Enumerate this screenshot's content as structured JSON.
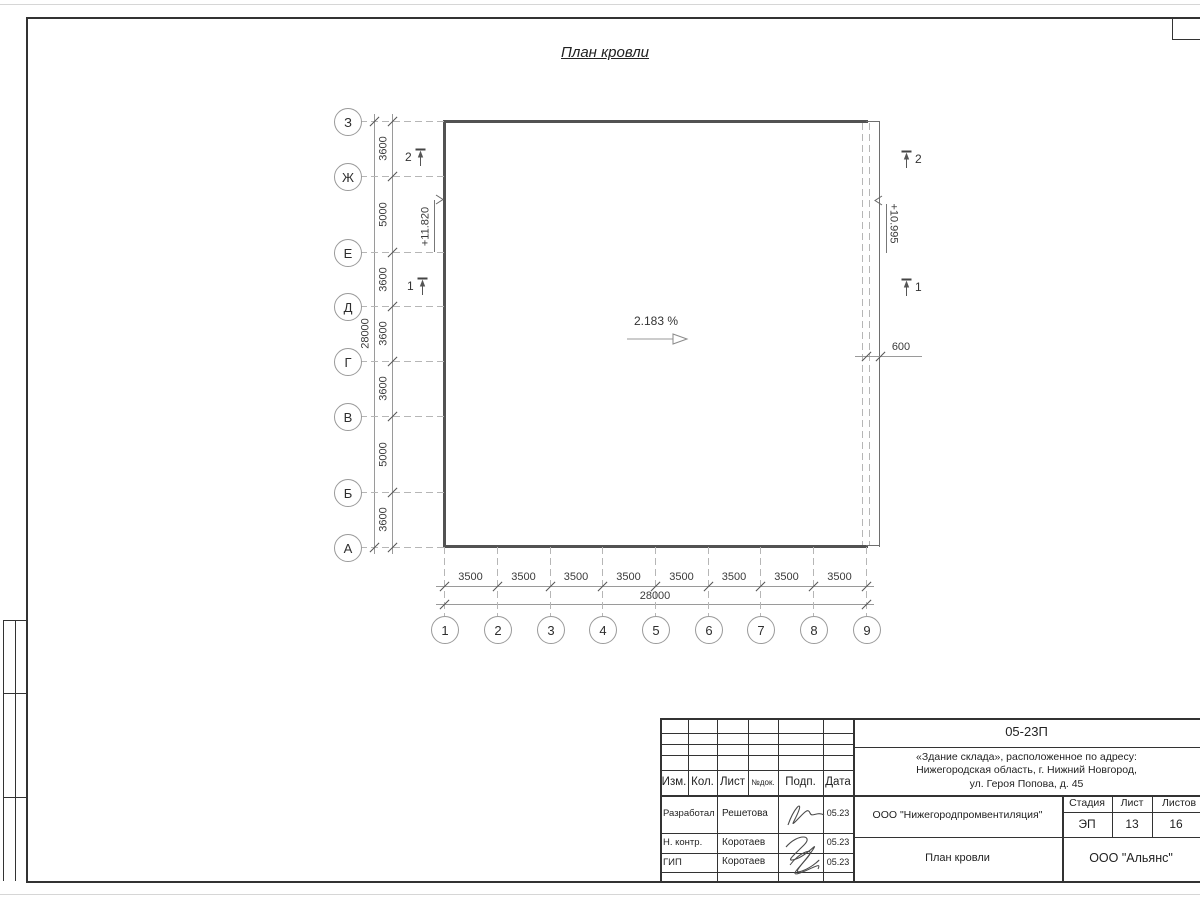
{
  "title": "План кровли",
  "plan": {
    "slope_label": "2.183 %",
    "elevation_left": "+11.820",
    "elevation_right": "+10.995",
    "overhang_dim": "600",
    "axes_left": [
      "З",
      "Ж",
      "Е",
      "Д",
      "Г",
      "В",
      "Б",
      "А"
    ],
    "axes_bottom": [
      "1",
      "2",
      "3",
      "4",
      "5",
      "6",
      "7",
      "8",
      "9"
    ],
    "dims_left": [
      "3600",
      "5000",
      "3600",
      "3600",
      "3600",
      "5000",
      "3600"
    ],
    "dims_left_total": "28000",
    "dims_bottom": [
      "3500",
      "3500",
      "3500",
      "3500",
      "3500",
      "3500",
      "3500",
      "3500"
    ],
    "dims_bottom_total": "28000",
    "section_marks": [
      "2",
      "1"
    ]
  },
  "title_block": {
    "doc_number": "05-23П",
    "project_lines": [
      "«Здание склада», расположенное по адресу:",
      "Нижегородская область, г. Нижний Новгород,",
      "ул. Героя Попова, д. 45"
    ],
    "header_cols": [
      "Изм.",
      "Кол.",
      "Лист",
      "№док.",
      "Подп.",
      "Дата"
    ],
    "rows": [
      {
        "role": "Разработал",
        "name": "Решетова",
        "date": "05.23"
      },
      {
        "role": "Н. контр.",
        "name": "Коротаев",
        "date": "05.23"
      },
      {
        "role": "ГИП",
        "name": "Коротаев",
        "date": "05.23"
      }
    ],
    "org": "ООО \"Нижегородпромвентиляция\"",
    "stage_label": "Стадия",
    "sheet_label": "Лист",
    "sheets_label": "Листов",
    "stage": "ЭП",
    "sheet": "13",
    "sheets": "16",
    "drawing_title": "План кровли",
    "company": "ООО \"Альянс\""
  }
}
